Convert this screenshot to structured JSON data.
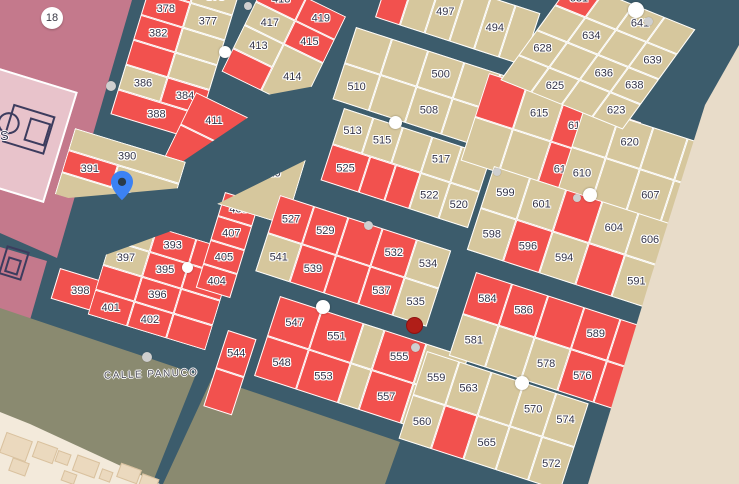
{
  "map": {
    "street_label": "CALLE PANUCO",
    "area_badge": "18",
    "partial_label": "S",
    "colors": {
      "road": "#3C5C6C",
      "parcel_tan": "#D6C79D",
      "parcel_red": "#F2514E",
      "pink": "#C4798C",
      "pink_light": "#E8C3CB",
      "icon_navy": "#3C3C5E",
      "olive": "#8A8A70",
      "cream": "#F3EADB",
      "beige": "#E8DCC9",
      "building": "#EBD9BE",
      "label": "#333347",
      "pin_blue": "#3C82F4",
      "red_marker": "#B01E18",
      "dot_white": "#FFFFFF",
      "dot_gray": "#CFCFCF"
    },
    "zones": [
      {
        "name": "pink-sports-area",
        "c": "pink",
        "z": 1,
        "pts": "0px 0px,132px 0px,57px 258px,0px 233px"
      },
      {
        "name": "pink-lower-block",
        "c": "pink",
        "z": 1,
        "pts": "0px 247px,47px 261px,30px 320px,0px 310px"
      },
      {
        "name": "olive-block-west",
        "c": "olive",
        "z": 1,
        "pts": "0px 308px,196px 374px,152px 484px,0px 420px"
      },
      {
        "name": "olive-block-east",
        "c": "olive",
        "z": 1,
        "pts": "212px 378px,400px 442px,385px 484px,163px 484px"
      },
      {
        "name": "cream-buildings-area",
        "c": "cream",
        "z": 2,
        "pts": "0px 412px,30px 424px,160px 484px,0px 484px"
      },
      {
        "name": "beige-outside-area",
        "c": "beige",
        "z": 30,
        "pts": "739px 45px,705px 105px,650px 280px,588px 484px,739px 484px"
      }
    ],
    "blocks": [
      {
        "x": 156,
        "y": -35,
        "rot": 17,
        "cw": 44,
        "ch": 26,
        "rows": [
          [
            [
              null,
              "r"
            ],
            [
              376,
              "t"
            ]
          ],
          [
            [
              378,
              "r"
            ],
            [
              377,
              "t"
            ]
          ],
          [
            [
              382,
              "r"
            ],
            [
              null,
              "t"
            ]
          ],
          [
            [
              null,
              "r"
            ],
            [
              null,
              "t"
            ]
          ],
          [
            [
              386,
              "t"
            ],
            [
              384,
              "r"
            ]
          ],
          [
            [
              388,
              "r",
              2
            ]
          ]
        ]
      },
      {
        "x": 267,
        "y": -22,
        "rot": 26,
        "cw": 44,
        "ch": 26,
        "clip": "0 0,100% 0,100% 75%,60% 100%,0 100%",
        "rows": [
          [
            [
              418,
              "r"
            ],
            [
              419,
              "r"
            ]
          ],
          [
            [
              417,
              "t"
            ],
            [
              415,
              "r"
            ]
          ],
          [
            [
              413,
              "t"
            ],
            [
              414,
              "t",
              1,
              2
            ]
          ],
          [
            [
              null,
              "r"
            ]
          ]
        ]
      },
      {
        "x": 196,
        "y": 92,
        "rot": 26,
        "cw": 58,
        "ch": 36,
        "clip": "0 0,100% 0,28% 100%,0 100%",
        "rows": [
          [
            [
              411,
              "r"
            ]
          ],
          [
            [
              null,
              "r"
            ]
          ]
        ]
      },
      {
        "x": 75,
        "y": 128,
        "rot": 17,
        "cw": 58,
        "ch": 23,
        "clip": "0 0,100% 0,100% 40%,12% 100%,0 100%",
        "rows": [
          [
            [
              390,
              "t",
              2
            ]
          ],
          [
            [
              391,
              "r",
              0.9
            ],
            [
              null,
              "t",
              1.1
            ]
          ],
          [
            [
              392,
              "t",
              2,
              1.7
            ]
          ]
        ]
      },
      {
        "x": 60,
        "y": 268,
        "rot": 17,
        "cw": 52,
        "ch": 32,
        "rows": [
          [
            [
              398,
              "r"
            ]
          ]
        ]
      },
      {
        "x": 118,
        "y": 215,
        "rot": 17,
        "cw": 41,
        "ch": 26,
        "clip": "45% 0,100% 0,100% 100%,0 100%,0 40%",
        "rows": [
          [
            [
              null,
              "t"
            ],
            [
              393,
              "r"
            ],
            [
              null,
              "r"
            ]
          ],
          [
            [
              397,
              "t"
            ],
            [
              395,
              "r"
            ],
            [
              null,
              "r"
            ]
          ],
          [
            [
              null,
              "r"
            ],
            [
              396,
              "r"
            ],
            [
              null,
              "r"
            ]
          ],
          [
            [
              401,
              "r"
            ],
            [
              402,
              "r"
            ],
            [
              null,
              "r"
            ]
          ]
        ]
      },
      {
        "x": 225,
        "y": 192,
        "rot": 17,
        "cw": 36,
        "ch": 25,
        "rows": [
          [
            [
              408,
              "r"
            ]
          ],
          [
            [
              407,
              "r"
            ]
          ],
          [
            [
              405,
              "r"
            ]
          ],
          [
            [
              404,
              "r"
            ]
          ]
        ]
      },
      {
        "x": 237,
        "y": 139,
        "rot": 17,
        "cw": 72,
        "ch": 68,
        "clip": "100% 0,100% 100%,0 100%",
        "lp": [
          0.6,
          0.34
        ],
        "rows": [
          [
            [
              410,
              "t"
            ]
          ]
        ]
      },
      {
        "x": 344,
        "y": 108,
        "rot": 18,
        "cw": 31,
        "ch": 38,
        "rows": [
          [
            [
              513,
              "t"
            ],
            [
              515,
              "t"
            ],
            [
              null,
              "t"
            ],
            [
              517,
              "t"
            ],
            [
              null,
              "t"
            ]
          ],
          [
            [
              525,
              "r",
              1.3
            ],
            [
              null,
              "r",
              0.85
            ],
            [
              null,
              "r",
              0.85
            ],
            [
              522,
              "t"
            ],
            [
              520,
              "t"
            ]
          ]
        ]
      },
      {
        "x": 280,
        "y": 195,
        "rot": 18,
        "cw": 36,
        "ch": 40,
        "rows": [
          [
            [
              527,
              "r"
            ],
            [
              529,
              "r"
            ],
            [
              null,
              "r"
            ],
            [
              532,
              "r"
            ],
            [
              534,
              "t"
            ]
          ],
          [
            [
              541,
              "t"
            ],
            [
              539,
              "r"
            ],
            [
              null,
              "r"
            ],
            [
              537,
              "r"
            ],
            [
              535,
              "t"
            ]
          ]
        ]
      },
      {
        "x": 228,
        "y": 330,
        "rot": 18,
        "cw": 30,
        "ch": 40,
        "rows": [
          [
            [
              544,
              "r"
            ]
          ],
          [
            [
              null,
              "r"
            ]
          ]
        ]
      },
      {
        "x": 280,
        "y": 296,
        "rot": 18,
        "cw": 44,
        "ch": 42,
        "rows": [
          [
            [
              547,
              "r"
            ],
            [
              551,
              "r"
            ],
            [
              null,
              "t",
              0.5
            ],
            [
              555,
              "r"
            ],
            [
              null,
              "t"
            ]
          ],
          [
            [
              548,
              "r"
            ],
            [
              553,
              "r"
            ],
            [
              null,
              "t",
              0.5
            ],
            [
              557,
              "r"
            ],
            [
              null,
              "t"
            ]
          ]
        ]
      },
      {
        "x": 392,
        "y": -35,
        "rot": 18,
        "cw": 26,
        "ch": 55,
        "rows": [
          [
            [
              492,
              "r"
            ],
            [
              null,
              "t"
            ],
            [
              497,
              "t"
            ],
            [
              null,
              "t"
            ],
            [
              494,
              "t"
            ],
            [
              null,
              "t"
            ]
          ]
        ]
      },
      {
        "x": 356,
        "y": 27,
        "rot": 18,
        "cw": 38,
        "ch": 38,
        "rows": [
          [
            [
              null,
              "t"
            ],
            [
              null,
              "t"
            ],
            [
              500,
              "t"
            ],
            [
              null,
              "t"
            ],
            [
              502,
              "t"
            ]
          ],
          [
            [
              510,
              "t"
            ],
            [
              null,
              "t"
            ],
            [
              508,
              "t"
            ],
            [
              null,
              "t"
            ],
            [
              504,
              "r"
            ]
          ]
        ]
      },
      {
        "x": 489,
        "y": 73,
        "rot": 18,
        "cw": 40,
        "ch": 46,
        "rows": [
          [
            [
              null,
              "r"
            ],
            [
              615,
              "t"
            ],
            [
              617,
              "r"
            ],
            [
              null,
              "r"
            ]
          ],
          [
            [
              null,
              "t"
            ],
            [
              null,
              "t"
            ],
            [
              612,
              "r"
            ],
            [
              null,
              "r"
            ]
          ]
        ]
      },
      {
        "x": 585,
        "y": 105,
        "rot": 18,
        "cw": 36,
        "ch": 44,
        "rows": [
          [
            [
              null,
              "t"
            ],
            [
              620,
              "t"
            ],
            [
              null,
              "t"
            ],
            [
              622,
              "t"
            ]
          ],
          [
            [
              610,
              "t"
            ],
            [
              null,
              "t"
            ],
            [
              607,
              "t"
            ],
            [
              null,
              "t"
            ]
          ]
        ]
      },
      {
        "x": 494,
        "y": 166,
        "rot": 18,
        "cw": 38,
        "ch": 44,
        "rows": [
          [
            [
              599,
              "t"
            ],
            [
              601,
              "t"
            ],
            [
              null,
              "r"
            ],
            [
              604,
              "t"
            ],
            [
              606,
              "t"
            ],
            [
              null,
              "t"
            ]
          ],
          [
            [
              598,
              "t"
            ],
            [
              596,
              "r"
            ],
            [
              594,
              "t"
            ],
            [
              null,
              "r"
            ],
            [
              591,
              "t"
            ],
            [
              null,
              "t"
            ]
          ]
        ]
      },
      {
        "x": 476,
        "y": 272,
        "rot": 18,
        "cw": 38,
        "ch": 44,
        "rows": [
          [
            [
              584,
              "r"
            ],
            [
              586,
              "r"
            ],
            [
              null,
              "r"
            ],
            [
              589,
              "r"
            ],
            [
              null,
              "r"
            ]
          ],
          [
            [
              581,
              "t"
            ],
            [
              null,
              "t"
            ],
            [
              578,
              "t"
            ],
            [
              576,
              "r"
            ],
            [
              null,
              "r"
            ]
          ]
        ]
      },
      {
        "x": 427,
        "y": 351,
        "rot": 18,
        "cw": 34,
        "ch": 46,
        "rows": [
          [
            [
              559,
              "t"
            ],
            [
              563,
              "t"
            ],
            [
              null,
              "t"
            ],
            [
              570,
              "t"
            ],
            [
              574,
              "t"
            ]
          ],
          [
            [
              560,
              "t"
            ],
            [
              null,
              "r"
            ],
            [
              565,
              "t"
            ],
            [
              null,
              "t"
            ],
            [
              572,
              "t"
            ]
          ]
        ]
      },
      {
        "x": 573,
        "y": -20,
        "rot": 22,
        "skew": -14,
        "cw": 33,
        "ch": 30,
        "rows": [
          [
            [
              631,
              "r"
            ],
            [
              null,
              "t"
            ],
            [
              641,
              "t"
            ],
            [
              null,
              "t"
            ]
          ],
          [
            [
              null,
              "t"
            ],
            [
              634,
              "t"
            ],
            [
              null,
              "t"
            ],
            [
              639,
              "t"
            ]
          ],
          [
            [
              628,
              "t"
            ],
            [
              null,
              "t"
            ],
            [
              636,
              "t"
            ],
            [
              638,
              "t"
            ]
          ],
          [
            [
              null,
              "t"
            ],
            [
              625,
              "t"
            ],
            [
              null,
              "t"
            ],
            [
              623,
              "t"
            ]
          ]
        ]
      }
    ],
    "dots": [
      [
        111,
        86,
        10,
        "g"
      ],
      [
        225,
        52,
        12,
        "w"
      ],
      [
        248,
        6,
        8,
        "g"
      ],
      [
        395,
        122,
        13,
        "w"
      ],
      [
        368,
        225,
        9,
        "g"
      ],
      [
        497,
        172,
        8,
        "g"
      ],
      [
        590,
        195,
        14,
        "w"
      ],
      [
        577,
        198,
        8,
        "g"
      ],
      [
        636,
        10,
        16,
        "w"
      ],
      [
        648,
        21,
        9,
        "g"
      ],
      [
        187,
        267,
        11,
        "w"
      ],
      [
        147,
        357,
        10,
        "g"
      ],
      [
        323,
        307,
        14,
        "w"
      ],
      [
        415,
        347,
        9,
        "g"
      ],
      [
        522,
        383,
        14,
        "w"
      ]
    ],
    "buildings": [
      [
        2,
        436,
        26,
        20
      ],
      [
        34,
        444,
        20,
        15
      ],
      [
        10,
        460,
        16,
        12
      ],
      [
        56,
        452,
        12,
        10
      ],
      [
        74,
        458,
        22,
        15
      ],
      [
        100,
        470,
        10,
        9
      ],
      [
        118,
        466,
        20,
        13
      ],
      [
        62,
        472,
        12,
        9
      ],
      [
        140,
        476,
        16,
        10
      ]
    ],
    "markers": {
      "pin": {
        "x": 111,
        "y": 170
      },
      "red_dot": {
        "x": 406,
        "y": 317
      }
    }
  }
}
